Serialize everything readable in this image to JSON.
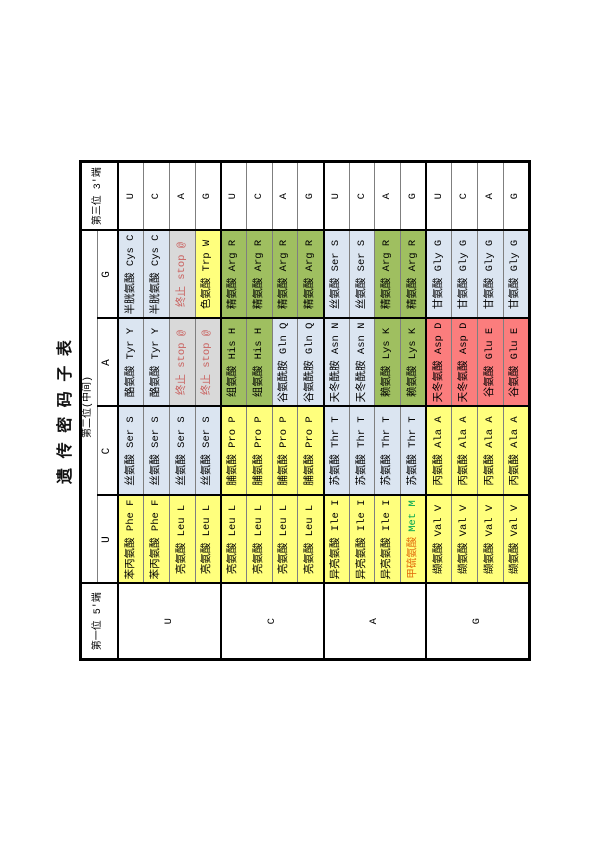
{
  "page": {
    "title": "遗 传 密 码 子 表"
  },
  "colors": {
    "yellow": "#ffff7d",
    "blue": "#dbe5f1",
    "green": "#9fbf60",
    "red": "#fb7d7d",
    "stop_bg": "#d9d9d9",
    "stop_text": "#c9615f",
    "met_cn": "#e26b0a",
    "met_en": "#00a550",
    "thin_border": "#7f7f7f",
    "thick_border": "#000000"
  },
  "table": {
    "header": {
      "first_pos": "第一位 5'端",
      "second_pos": "第二位(中间)",
      "third_pos": "第三位 3'端",
      "second_letters": [
        "U",
        "C",
        "A",
        "G"
      ]
    },
    "groups": [
      {
        "first": "U",
        "rows": [
          {
            "third": "U",
            "cells": [
              {
                "text": "苯丙氨酸 Phe F",
                "color": "yellow"
              },
              {
                "text": "丝氨酸 Ser S",
                "color": "blue"
              },
              {
                "text": "酪氨酸 Tyr Y",
                "color": "blue"
              },
              {
                "text": "半胱氨酸 Cys C",
                "color": "blue"
              }
            ]
          },
          {
            "third": "C",
            "cells": [
              {
                "text": "苯丙氨酸 Phe F",
                "color": "yellow"
              },
              {
                "text": "丝氨酸 Ser S",
                "color": "blue"
              },
              {
                "text": "酪氨酸 Tyr Y",
                "color": "blue"
              },
              {
                "text": "半胱氨酸 Cys C",
                "color": "blue"
              }
            ]
          },
          {
            "third": "A",
            "cells": [
              {
                "text": "亮氨酸 Leu L",
                "color": "yellow"
              },
              {
                "text": "丝氨酸 Ser S",
                "color": "blue"
              },
              {
                "text": "终止 stop @",
                "color": "stop"
              },
              {
                "text": "终止 stop @",
                "color": "stop"
              }
            ]
          },
          {
            "third": "G",
            "cells": [
              {
                "text": "亮氨酸 Leu L",
                "color": "yellow"
              },
              {
                "text": "丝氨酸 Ser S",
                "color": "blue"
              },
              {
                "text": "终止 stop @",
                "color": "stop"
              },
              {
                "text": "色氨酸 Trp W",
                "color": "yellow"
              }
            ]
          }
        ]
      },
      {
        "first": "C",
        "rows": [
          {
            "third": "U",
            "cells": [
              {
                "text": "亮氨酸 Leu L",
                "color": "yellow"
              },
              {
                "text": "脯氨酸 Pro P",
                "color": "yellow"
              },
              {
                "text": "组氨酸 His H",
                "color": "green"
              },
              {
                "text": "精氨酸 Arg R",
                "color": "green"
              }
            ]
          },
          {
            "third": "C",
            "cells": [
              {
                "text": "亮氨酸 Leu L",
                "color": "yellow"
              },
              {
                "text": "脯氨酸 Pro P",
                "color": "yellow"
              },
              {
                "text": "组氨酸 His H",
                "color": "green"
              },
              {
                "text": "精氨酸 Arg R",
                "color": "green"
              }
            ]
          },
          {
            "third": "A",
            "cells": [
              {
                "text": "亮氨酸 Leu L",
                "color": "yellow"
              },
              {
                "text": "脯氨酸 Pro P",
                "color": "yellow"
              },
              {
                "text": "谷氨酰胺 Gln Q",
                "color": "blue"
              },
              {
                "text": "精氨酸 Arg R",
                "color": "green"
              }
            ]
          },
          {
            "third": "G",
            "cells": [
              {
                "text": "亮氨酸 Leu L",
                "color": "yellow"
              },
              {
                "text": "脯氨酸 Pro P",
                "color": "yellow"
              },
              {
                "text": "谷氨酰胺 Gln Q",
                "color": "blue"
              },
              {
                "text": "精氨酸 Arg R",
                "color": "green"
              }
            ]
          }
        ]
      },
      {
        "first": "A",
        "rows": [
          {
            "third": "U",
            "cells": [
              {
                "text": "异亮氨酸 Ile I",
                "color": "yellow"
              },
              {
                "text": "苏氨酸 Thr T",
                "color": "blue"
              },
              {
                "text": "天冬酰胺 Asn N",
                "color": "blue"
              },
              {
                "text": "丝氨酸 Ser S",
                "color": "blue"
              }
            ]
          },
          {
            "third": "C",
            "cells": [
              {
                "text": "异亮氨酸 Ile I",
                "color": "yellow"
              },
              {
                "text": "苏氨酸 Thr T",
                "color": "blue"
              },
              {
                "text": "天冬酰胺 Asn N",
                "color": "blue"
              },
              {
                "text": "丝氨酸 Ser S",
                "color": "blue"
              }
            ]
          },
          {
            "third": "A",
            "cells": [
              {
                "text": "异亮氨酸 Ile I",
                "color": "yellow"
              },
              {
                "text": "苏氨酸 Thr T",
                "color": "blue"
              },
              {
                "text": "赖氨酸 Lys K",
                "color": "green"
              },
              {
                "text": "精氨酸 Arg R",
                "color": "green"
              }
            ]
          },
          {
            "third": "G",
            "cells": [
              {
                "cn": "甲硫氨酸",
                "en": "Met M",
                "color": "met"
              },
              {
                "text": "苏氨酸 Thr T",
                "color": "blue"
              },
              {
                "text": "赖氨酸 Lys K",
                "color": "green"
              },
              {
                "text": "精氨酸 Arg R",
                "color": "green"
              }
            ]
          }
        ]
      },
      {
        "first": "G",
        "rows": [
          {
            "third": "U",
            "cells": [
              {
                "text": "缬氨酸 Val V",
                "color": "yellow"
              },
              {
                "text": "丙氨酸 Ala A",
                "color": "yellow"
              },
              {
                "text": "天冬氨酸 Asp D",
                "color": "red"
              },
              {
                "text": "甘氨酸 Gly G",
                "color": "blue"
              }
            ]
          },
          {
            "third": "C",
            "cells": [
              {
                "text": "缬氨酸 Val V",
                "color": "yellow"
              },
              {
                "text": "丙氨酸 Ala A",
                "color": "yellow"
              },
              {
                "text": "天冬氨酸 Asp D",
                "color": "red"
              },
              {
                "text": "甘氨酸 Gly G",
                "color": "blue"
              }
            ]
          },
          {
            "third": "A",
            "cells": [
              {
                "text": "缬氨酸 Val V",
                "color": "yellow"
              },
              {
                "text": "丙氨酸 Ala A",
                "color": "yellow"
              },
              {
                "text": "谷氨酸 Glu E",
                "color": "red"
              },
              {
                "text": "甘氨酸 Gly G",
                "color": "blue"
              }
            ]
          },
          {
            "third": "G",
            "cells": [
              {
                "text": "缬氨酸 Val V",
                "color": "yellow"
              },
              {
                "text": "丙氨酸 Ala A",
                "color": "yellow"
              },
              {
                "text": "谷氨酸 Glu E",
                "color": "red"
              },
              {
                "text": "甘氨酸 Gly G",
                "color": "blue"
              }
            ]
          }
        ]
      }
    ]
  }
}
